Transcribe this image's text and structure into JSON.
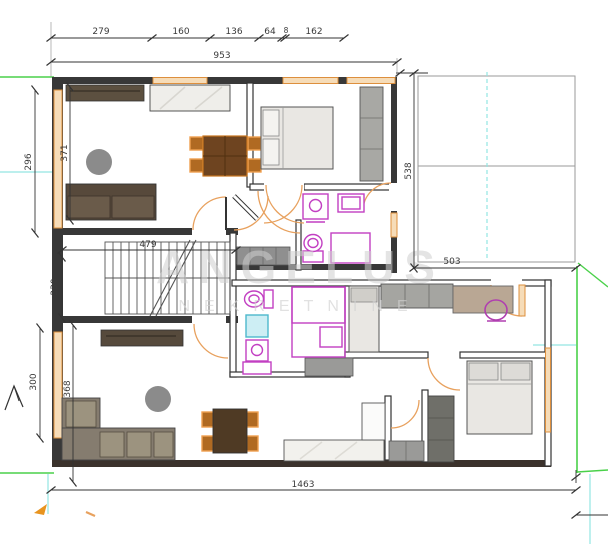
{
  "plan": {
    "watermark": {
      "title": "ANGELUS",
      "subtitle": "NEKRETNINE"
    },
    "dimensions": {
      "top_segments": [
        "279",
        "160",
        "136",
        "64",
        "8",
        "162"
      ],
      "top_total": "953",
      "upper_left_outer": "296",
      "upper_left_inner": "371",
      "terrace_height": "538",
      "terrace_width": "503",
      "stair_hall_width": "479",
      "stair_hall_height": "230",
      "lower_left_outer": "300",
      "lower_left_inner": "368",
      "bottom_total": "1463"
    },
    "colors": {
      "wall": "#383838",
      "window": "#dd8f3d",
      "window_fill": "#f6dcb8",
      "door_arc": "#e8a15e",
      "fixture": "#c23fc2",
      "shower_fill": "#cdeef4",
      "boundary_green": "#4ad14a",
      "guide_cyan": "#93e5e2",
      "reference_red": "#b05050",
      "furniture_dark": "#57493b",
      "furniture_gray": "#9a9a98",
      "bed_fill": "#e9e7e3",
      "watermark": "#cfcfcf",
      "dimension_text": "#3a3a3a"
    }
  }
}
